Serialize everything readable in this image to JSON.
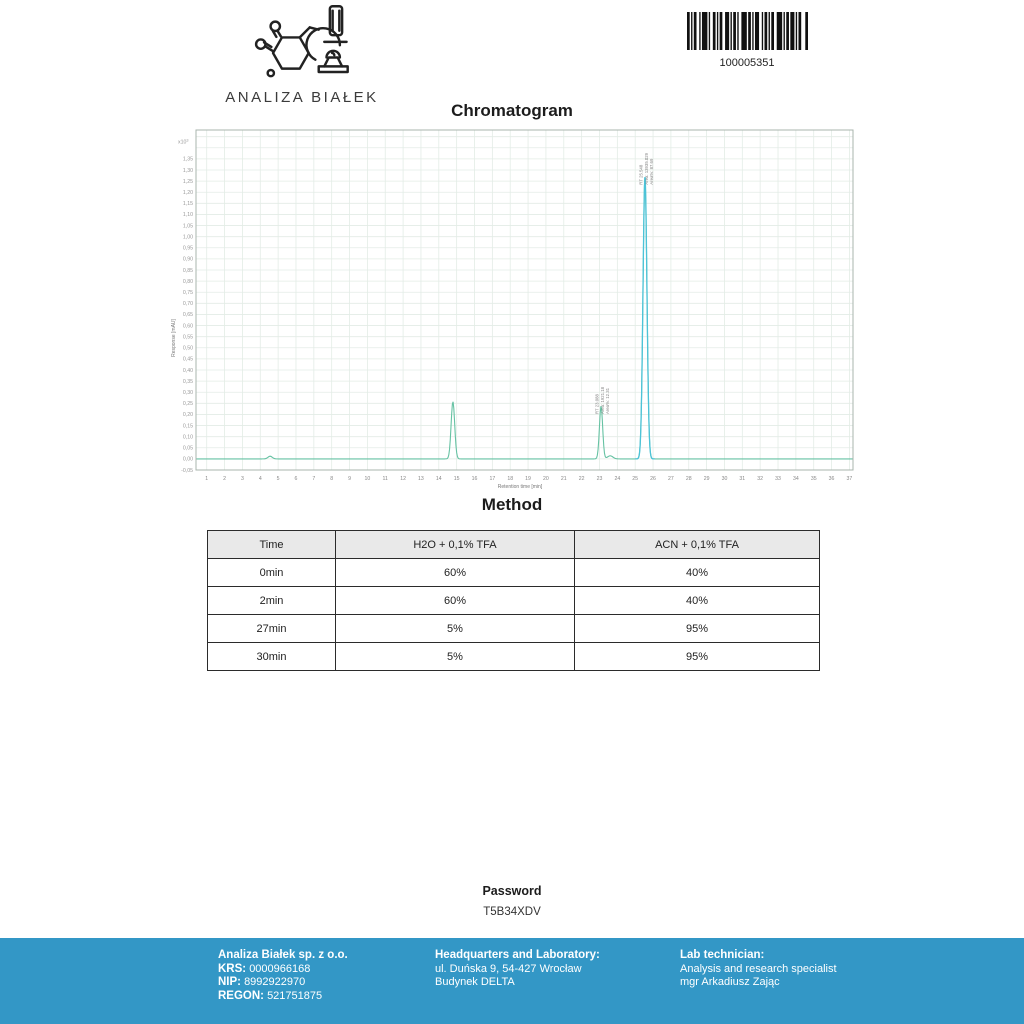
{
  "logo": {
    "title": "ANALIZA BIAŁEK"
  },
  "barcode": {
    "value": "100005351"
  },
  "chromatogram_section": {
    "title": "Chromatogram"
  },
  "chart_data": {
    "type": "line",
    "title": "Chromatogram",
    "xlabel": "Retention time [min]",
    "ylabel": "Response [mAU]",
    "y_scale_label": "x10",
    "y_scale_exponent": "3",
    "xlim": [
      0.4,
      37.2
    ],
    "ylim": [
      -0.05,
      1.48
    ],
    "xticks": [
      1,
      2,
      3,
      4,
      5,
      6,
      7,
      8,
      9,
      10,
      11,
      12,
      13,
      14,
      15,
      16,
      17,
      18,
      19,
      20,
      21,
      22,
      23,
      24,
      25,
      26,
      27,
      28,
      29,
      30,
      31,
      32,
      33,
      34,
      35,
      36,
      37
    ],
    "ytick_min": -0.05,
    "ytick_max": 1.35,
    "ytick_step": 0.05,
    "grid": true,
    "baseline": 0,
    "peaks": [
      {
        "rt": 4.55,
        "height_mau": 12,
        "sigma": 0.12,
        "main": false,
        "labels": []
      },
      {
        "rt": 14.79,
        "height_mau": 258,
        "sigma": 0.1,
        "main": false,
        "labels": []
      },
      {
        "rt": 23.088,
        "height_mau": 238,
        "sigma": 0.09,
        "main": false,
        "labels": [
          "RT 23.088",
          "Area: 1921.18",
          "Area%: 12.31"
        ]
      },
      {
        "rt": 23.6,
        "height_mau": 14,
        "sigma": 0.15,
        "main": false,
        "labels": []
      },
      {
        "rt": 25.548,
        "height_mau": 1270,
        "sigma": 0.11,
        "main": true,
        "labels": [
          "RT 25.548",
          "Area: 13935.029",
          "Area%: 87.69"
        ]
      }
    ],
    "colors": {
      "trace": "#66c2a3",
      "main_peak": "#4cc3d8",
      "grid": "#e3ece6",
      "frame": "#a9b4ae"
    }
  },
  "method": {
    "title": "Method",
    "columns": [
      "Time",
      "H2O + 0,1% TFA",
      "ACN + 0,1% TFA"
    ],
    "rows": [
      [
        "0min",
        "60%",
        "40%"
      ],
      [
        "2min",
        "60%",
        "40%"
      ],
      [
        "27min",
        "5%",
        "95%"
      ],
      [
        "30min",
        "5%",
        "95%"
      ]
    ]
  },
  "password": {
    "label": "Password",
    "value": "T5B34XDV"
  },
  "footer": {
    "bg_color": "#3397c6",
    "company": {
      "name": "Analiza Białek sp. z o.o.",
      "krs_label": "KRS:",
      "krs": "0000966168",
      "nip_label": "NIP:",
      "nip": "8992922970",
      "regon_label": "REGON:",
      "regon": "521751875"
    },
    "hq": {
      "title": "Headquarters and Laboratory:",
      "address_line1": "ul. Duńska 9, 54-427 Wrocław",
      "address_line2": "Budynek DELTA"
    },
    "technician": {
      "title": "Lab technician:",
      "line1": "Analysis and research specialist",
      "line2": "mgr Arkadiusz Zając"
    }
  }
}
